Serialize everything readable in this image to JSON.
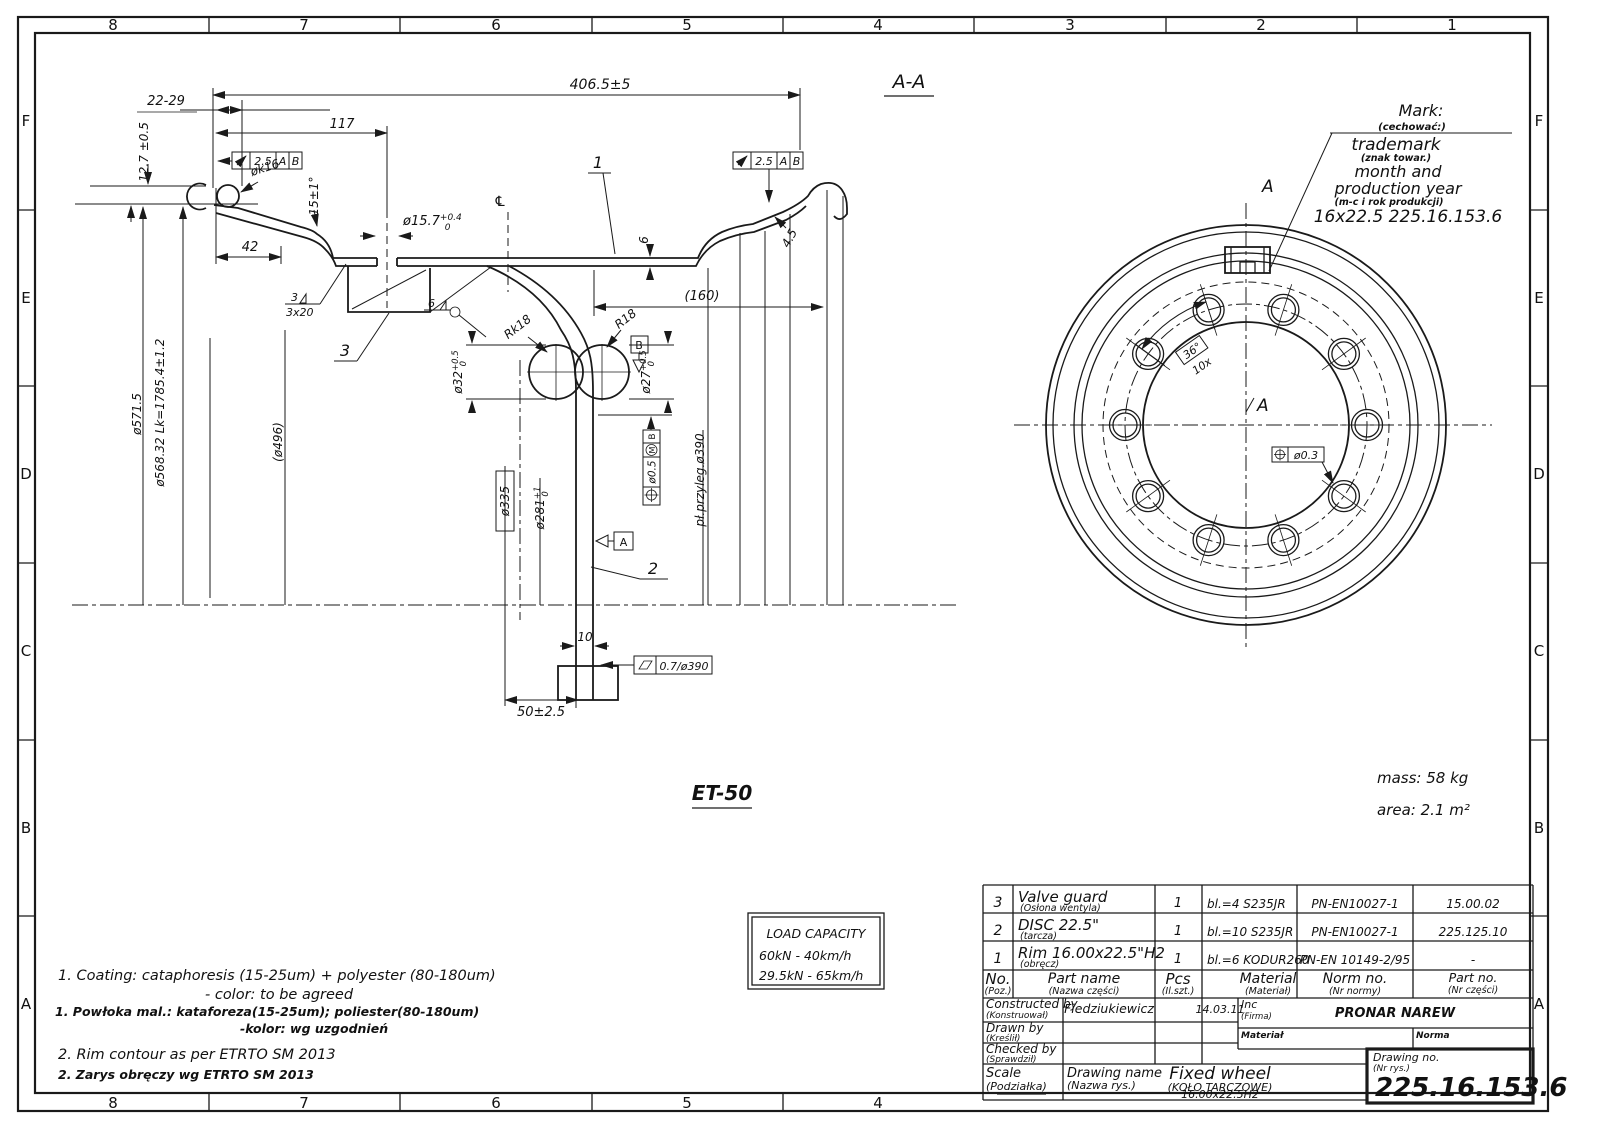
{
  "border": {
    "top_zones": [
      "8",
      "7",
      "6",
      "5",
      "4",
      "3",
      "2",
      "1"
    ],
    "bottom_zones": [
      "8",
      "7",
      "6",
      "5",
      "4"
    ],
    "left_zones": [
      "F",
      "E",
      "D",
      "C",
      "B",
      "A"
    ],
    "right_zones": [
      "F",
      "E",
      "D",
      "C",
      "B",
      "A"
    ]
  },
  "section": {
    "title": "A-A",
    "et_label": "ET-50",
    "balloons": {
      "b1": "1",
      "b2": "2",
      "b3": "3"
    },
    "welds": {
      "w3": "3",
      "w3x20": "3x20",
      "w6": "6"
    },
    "dims": {
      "overall": "406.5±5",
      "range_22_29": "22-29",
      "d117": "117",
      "d12_7": "12.7 ±0.5",
      "dk16": "øk16",
      "d15deg": "15±1°",
      "d15_7": "ø15.7",
      "d15_7_up": "+0.4",
      "d15_7_dn": "0",
      "d42": "42",
      "d160": "(160)",
      "rk18": "Rk18",
      "r18": "R18",
      "d32": "ø32",
      "d32_up": "+0.5",
      "d32_dn": "0",
      "d27": "ø27",
      "d27_up": "+0.5",
      "d27_dn": "0",
      "d335": "ø335",
      "d281": "ø281",
      "d281_up": "+1",
      "d281_dn": "0",
      "mount_face": "pł.przyleg.ø390",
      "d571": "ø571.5",
      "d568": "ø568.32",
      "lk": "Lk=1785.4±1.2",
      "d496": "(ø496)",
      "d10": "10",
      "d50": "50±2.5",
      "d6": "6",
      "d4_5": "4.5",
      "cl": "℄"
    },
    "fcf": {
      "runout_val": "2.5",
      "runout_dA": "A",
      "runout_dB": "B",
      "pos_val": "ø0.5",
      "pos_mod": "M",
      "pos_datum": "B",
      "flat_val": "0.7/ø390",
      "datum_a": "A",
      "datum_b": "B"
    }
  },
  "front": {
    "section_letter": "A",
    "count_label": "10x",
    "angle_label": "36°",
    "pos_tol": "ø0.3",
    "mass": "mass:  58 kg",
    "area": "area:  2.1 m²",
    "mark": {
      "title": "Mark:",
      "title_pl": "(cechować:)",
      "line1": "trademark",
      "line1_pl": "(znak towar.)",
      "line2": "month  and",
      "line3": "production  year",
      "line3_pl": "(m-c i rok produkcji)",
      "line4": "16x22.5    225.16.153.6"
    }
  },
  "notes": {
    "n1_en_a": "1.  Coating:   cataphoresis  (15-25um)  +  polyester  (80-180um)",
    "n1_en_b": "-  color:   to  be  agreed",
    "n1_pl_a": "1.  Powłoka  mal.:   kataforeza(15-25um);   poliester(80-180um)",
    "n1_pl_b": "-kolor:   wg  uzgodnień",
    "n2_en": "2.  Rim  contour  as  per  ETRTO  SM  2013",
    "n2_pl": "2.  Zarys  obręczy  wg  ETRTO  SM  2013"
  },
  "load_capacity": {
    "title": "LOAD  CAPACITY",
    "row1": "60kN  -  40km/h",
    "row2": "29.5kN  -  65km/h"
  },
  "title_block": {
    "rows": [
      {
        "no": "3",
        "name": "Valve guard",
        "name_pl": "(Osłona wentyla)",
        "pcs": "1",
        "material": "bl.=4   S235JR",
        "norm": "PN-EN10027-1",
        "part_no": "15.00.02"
      },
      {
        "no": "2",
        "name": "DISC 22.5\"",
        "name_pl": "(tarcza)",
        "pcs": "1",
        "material": "bl.=10 S235JR",
        "norm": "PN-EN10027-1",
        "part_no": "225.125.10"
      },
      {
        "no": "1",
        "name": "Rim 16.00x22.5\"H2",
        "name_pl": "(obręcz)",
        "pcs": "1",
        "material": "bl.=6 KODUR260",
        "norm": "PN-EN 10149-2/95",
        "part_no": "-"
      }
    ],
    "headers": {
      "no": "No.",
      "no_pl": "(Poz.)",
      "name": "Part name",
      "name_pl": "(Nazwa części)",
      "pcs": "Pcs",
      "pcs_pl": "(Il.szt.)",
      "material": "Material",
      "material_pl": "(Materiał)",
      "norm": "Norm no.",
      "norm_pl": "(Nr normy)",
      "part_no": "Part no.",
      "part_no_pl": "(Nr części)"
    },
    "constructed_by": "Constructed by",
    "constructed_by_pl": "(Konstruował)",
    "constructed_name": "Fiedziukiewicz",
    "date": "14.03.11",
    "inc": "Inc",
    "inc_pl": "(Firma)",
    "company": "PRONAR NAREW",
    "drawn_by": "Drawn by",
    "drawn_by_pl": "(Kreślił)",
    "checked_by": "Checked by",
    "checked_by_pl": "(Sprawdził)",
    "material_label": "Materiał",
    "norm_label": "Norma",
    "scale": "Scale",
    "scale_pl": "(Podziałka)",
    "drawing_name": "Drawing name",
    "drawing_name_pl": "(Nazwa rys.)",
    "product": "Fixed wheel",
    "product_pl": "(KOŁO TARCZOWE)",
    "product_size": "16.00x22.5H2",
    "drawing_no_label": "Drawing no.",
    "drawing_no_pl": "(Nr rys.)",
    "drawing_no": "225.16.153.6"
  }
}
